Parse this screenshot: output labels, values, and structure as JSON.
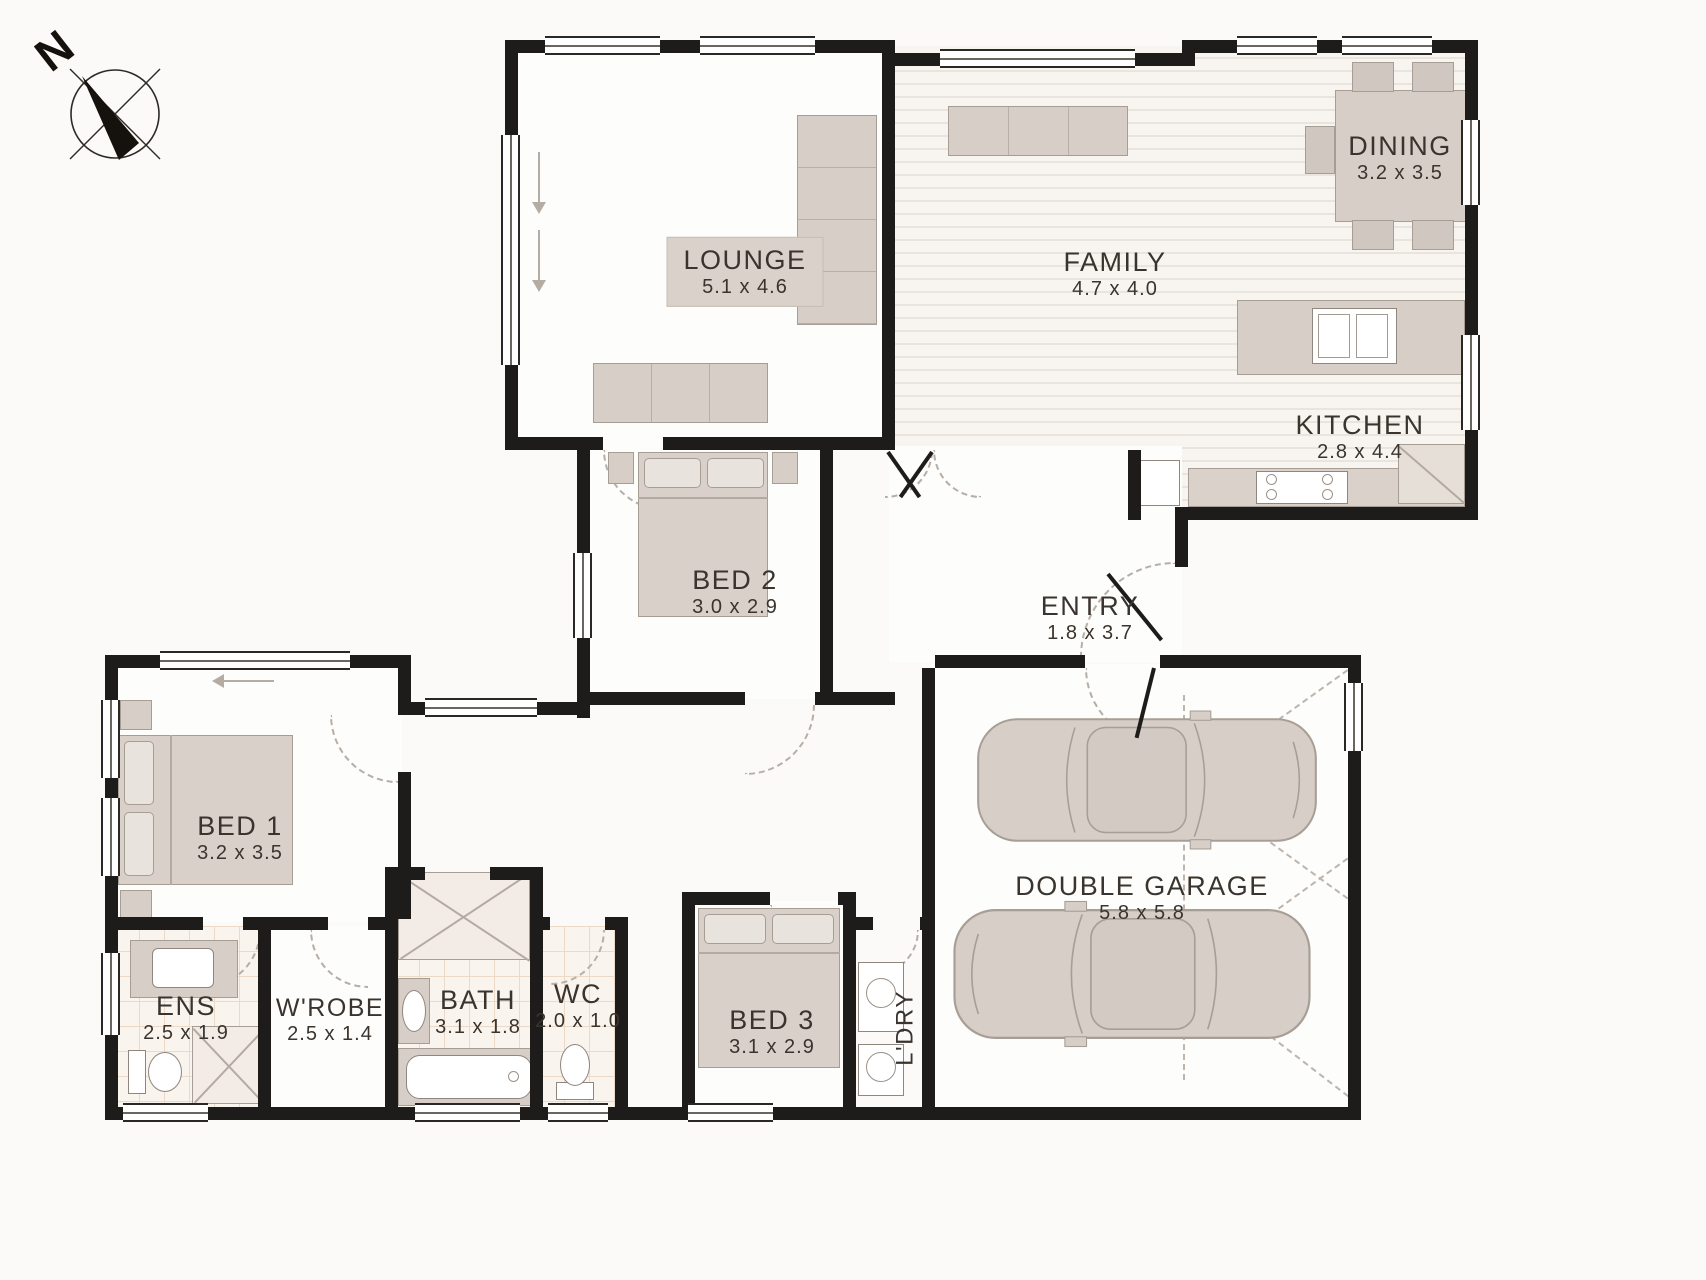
{
  "plan": {
    "compass": {
      "label": "N"
    },
    "rooms": {
      "lounge": {
        "name": "LOUNGE",
        "dims": "5.1 x 4.6"
      },
      "family": {
        "name": "FAMILY",
        "dims": "4.7 x 4.0"
      },
      "dining": {
        "name": "DINING",
        "dims": "3.2 x 3.5"
      },
      "kitchen": {
        "name": "KITCHEN",
        "dims": "2.8 x 4.4"
      },
      "entry": {
        "name": "ENTRY",
        "dims": "1.8 x 3.7"
      },
      "bed1": {
        "name": "BED 1",
        "dims": "3.2 x 3.5"
      },
      "bed2": {
        "name": "BED 2",
        "dims": "3.0 x 2.9"
      },
      "bed3": {
        "name": "BED 3",
        "dims": "3.1 x 2.9"
      },
      "ens": {
        "name": "ENS",
        "dims": "2.5 x 1.9"
      },
      "wrobe": {
        "name": "W'ROBE",
        "dims": "2.5 x 1.4"
      },
      "bath": {
        "name": "BATH",
        "dims": "3.1 x 1.8"
      },
      "wc": {
        "name": "WC",
        "dims": "2.0 x 1.0"
      },
      "ldry": {
        "name": "L'DRY"
      },
      "garage": {
        "name": "DOUBLE GARAGE",
        "dims": "5.8 x 5.8"
      }
    },
    "colors": {
      "wall": "#1e1c1a",
      "furniture": "#d6cec7",
      "label_text": "#3a342e",
      "tile_line": "#ecd9c7",
      "wood_stripe": "#eae4de"
    }
  }
}
